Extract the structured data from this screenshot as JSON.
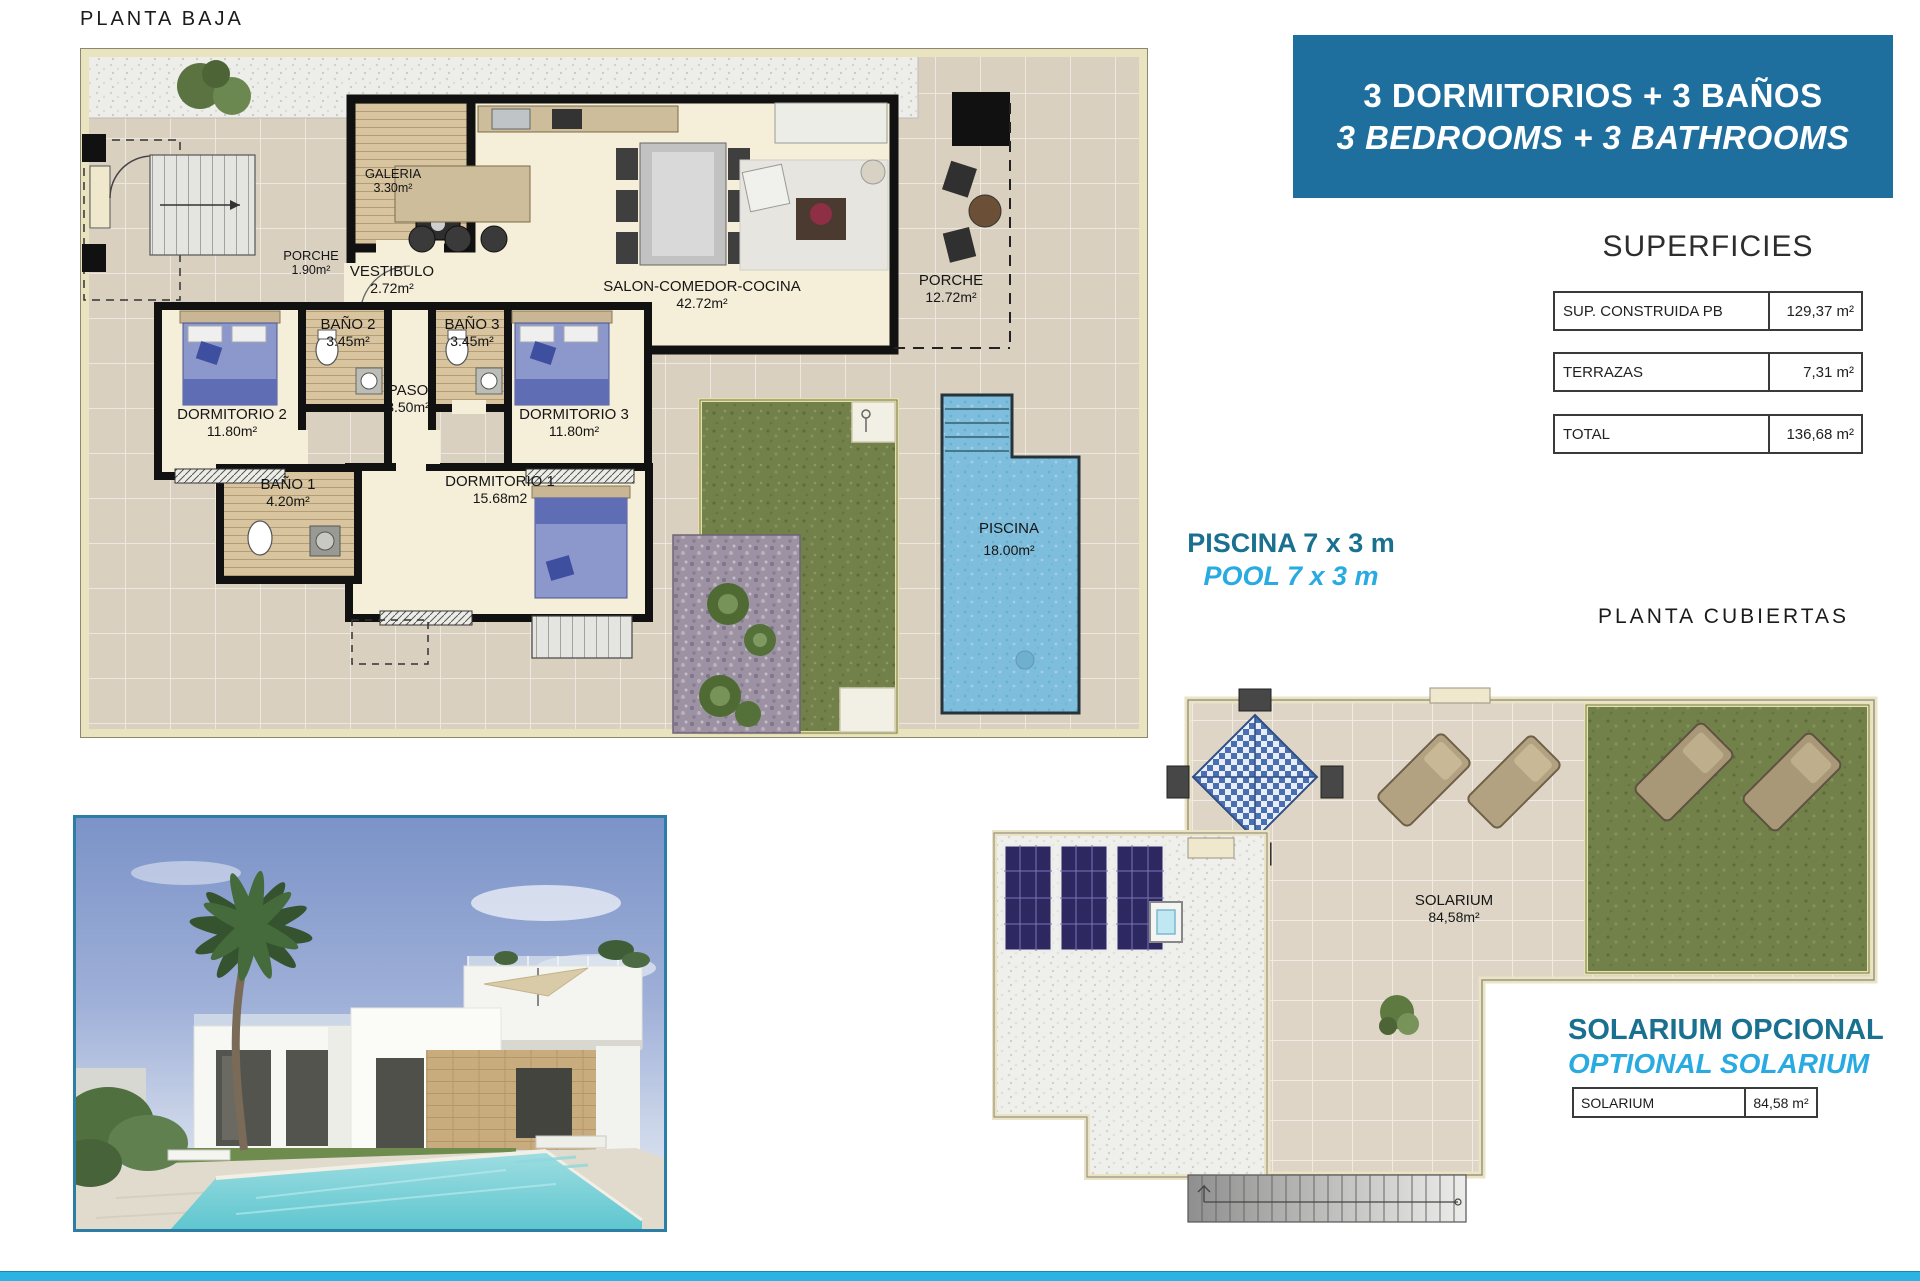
{
  "titles": {
    "planta_baja": "PLANTA BAJA",
    "planta_cubiertas": "PLANTA CUBIERTAS"
  },
  "banner": {
    "line1": "3 DORMITORIOS + 3 BAÑOS",
    "line2": "3 BEDROOMS + 3 BATHROOMS",
    "bg_color": "#1F6F9E"
  },
  "superficies": {
    "title": "SUPERFICIES",
    "rows": [
      {
        "label": "SUP. CONSTRUIDA PB",
        "value": "129,37 m²"
      },
      {
        "label": "TERRAZAS",
        "value": "7,31 m²"
      },
      {
        "label": "TOTAL",
        "value": "136,68 m²"
      }
    ]
  },
  "pool_note": {
    "line1": "PISCINA 7 x 3 m",
    "line2": "POOL 7 x 3 m",
    "color_dark": "#19708F",
    "color_cyan": "#29ABE2"
  },
  "floor_plan": {
    "rooms": [
      {
        "name": "GALERIA",
        "area": "3.30m²"
      },
      {
        "name": "PORCHE",
        "area": "1.90m²"
      },
      {
        "name": "VESTIBULO",
        "area": "2.72m²"
      },
      {
        "name": "SALON-COMEDOR-COCINA",
        "area": "42.72m²"
      },
      {
        "name": "PORCHE",
        "area": "12.72m²"
      },
      {
        "name": "BAÑO 2",
        "area": "3.45m²"
      },
      {
        "name": "BAÑO 3",
        "area": "3.45m²"
      },
      {
        "name": "PASO",
        "area": "3.50m²"
      },
      {
        "name": "DORMITORIO 2",
        "area": "11.80m²"
      },
      {
        "name": "DORMITORIO 3",
        "area": "11.80m²"
      },
      {
        "name": "BAÑO 1",
        "area": "4.20m²"
      },
      {
        "name": "DORMITORIO 1",
        "area": "15.68m2"
      },
      {
        "name": "PISCINA",
        "area": "18.00m²"
      }
    ]
  },
  "roof_plan": {
    "label": "SOLARIUM",
    "area": "84,58m²"
  },
  "solarium_note": {
    "line1": "SOLARIUM OPCIONAL",
    "line2": "OPTIONAL SOLARIUM",
    "table_label": "SOLARIUM",
    "table_value": "84,58 m²"
  },
  "footer": {
    "bar_color": "#2BB4E3"
  }
}
